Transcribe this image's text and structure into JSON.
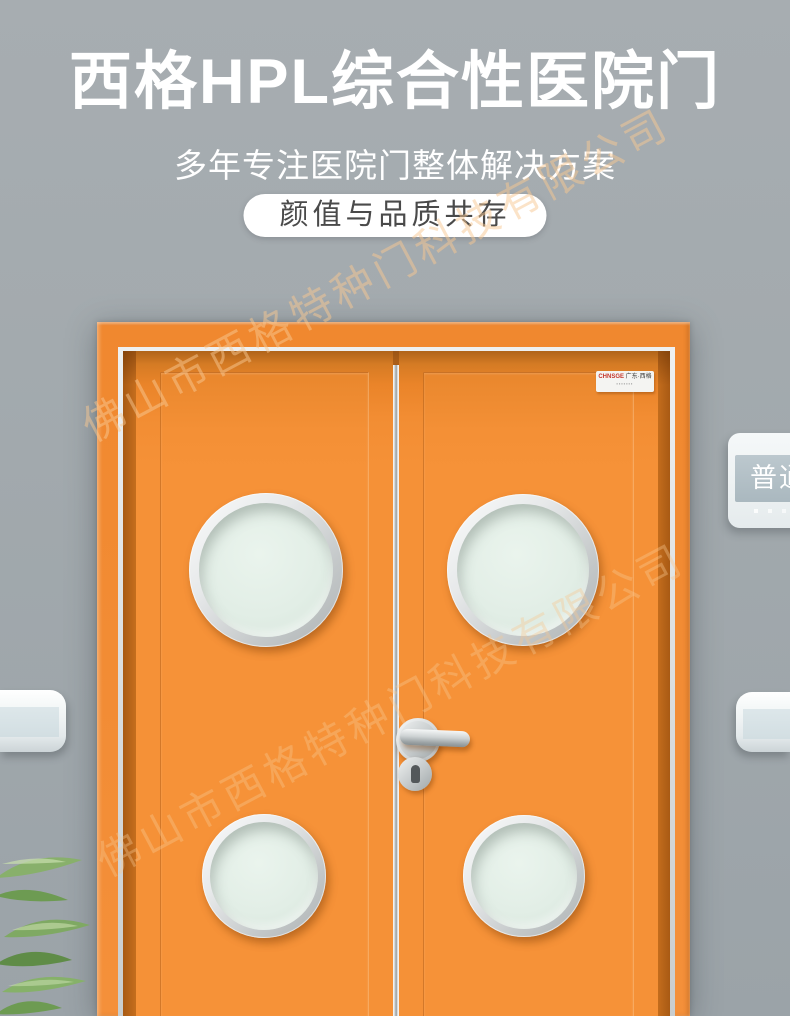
{
  "header": {
    "title": "西格HPL综合性医院门",
    "subtitle": "多年专注医院门整体解决方案",
    "badge": "颜值与品质共存"
  },
  "watermark": {
    "text": "佛山市西格特种门科技有限公司"
  },
  "door": {
    "brand_label": {
      "latin": "CHNSGE",
      "cn": "广东·西格",
      "micro_row": "▪▪▪▪▪▪▪"
    }
  },
  "wall_sign": {
    "label": "普通"
  },
  "colors": {
    "door_orange": "#F59137",
    "door_reveal_dark": "#CD7522",
    "wall_gray": "#A3AAAE",
    "glass_mint": "#E3EEE6",
    "rim_silver": "#D9DCDD",
    "badge_bg": "#FFFFFF",
    "badge_text": "#4A4A4A",
    "title_text": "#FFFFFF",
    "sign_band": "#AFBCC3",
    "rail_band": "#D6E1E5",
    "watermark_tint": "#F7C791",
    "plant_green": "#7FAB63"
  }
}
